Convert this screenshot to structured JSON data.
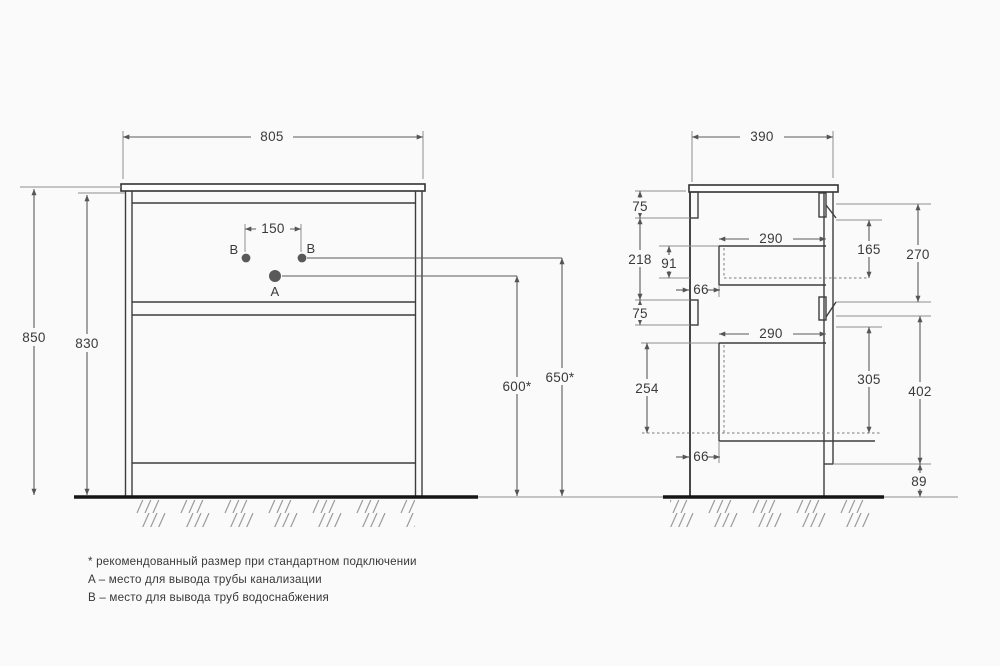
{
  "drawing": {
    "front": {
      "width": "805",
      "height_total": "850",
      "height_carcass": "830",
      "hole_spacing": "150",
      "point_b_left": "B",
      "point_b_right": "B",
      "point_a": "A",
      "drain_height": "600*",
      "water_height": "650*"
    },
    "side": {
      "depth": "390",
      "top_rail": "75",
      "span_218": "218",
      "span_91": "91",
      "recess_top": "66",
      "drawer_top_width": "290",
      "span_165": "165",
      "span_270": "270",
      "mid_rail": "75",
      "drawer_bottom_width": "290",
      "span_254": "254",
      "span_305": "305",
      "span_402": "402",
      "recess_bottom": "66",
      "plinth": "89"
    },
    "legend": {
      "note_recommended": "* рекомендованный размер при стандартном подключении",
      "note_a": "A – место для вывода трубы канализации",
      "note_b": "B – место для вывода труб водоснабжения"
    },
    "colors": {
      "object_line": "#3d3d3d",
      "dimension_line": "#5a5a5a",
      "text": "#3a3a3a",
      "floor": "#161616",
      "background": "#fafafa"
    }
  }
}
